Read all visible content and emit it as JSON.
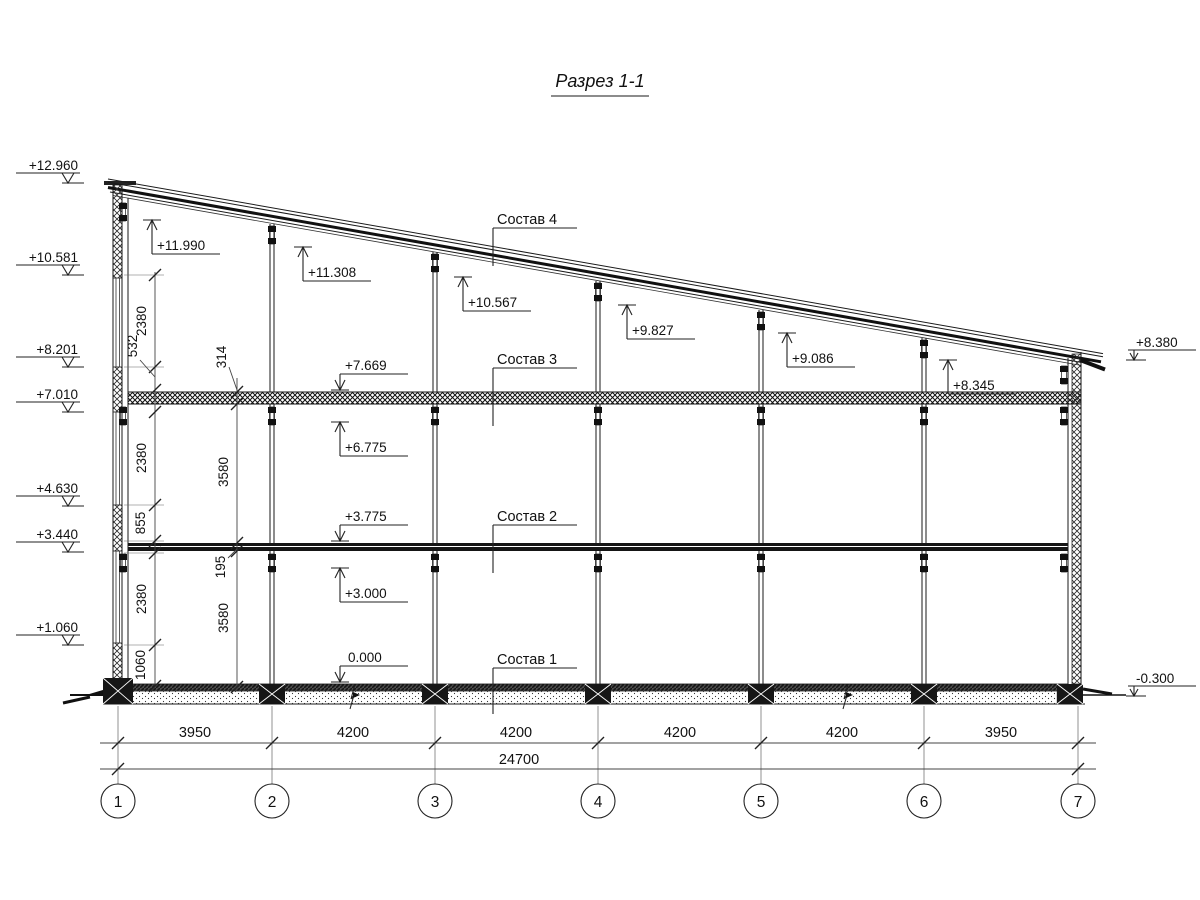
{
  "title": "Разрез 1-1",
  "layers": [
    "Состав 4",
    "Состав 3",
    "Состав 2",
    "Состав 1"
  ],
  "marks": {
    "left": [
      "+12.960",
      "+10.581",
      "+8.201",
      "+7.010",
      "+4.630",
      "+3.440",
      "+1.060"
    ],
    "right": [
      "+8.380",
      "-0.300"
    ],
    "roof": [
      "+11.990",
      "+11.308",
      "+10.567",
      "+9.827",
      "+9.086",
      "+8.345"
    ],
    "mid": [
      "+7.669",
      "+6.775",
      "+3.775",
      "+3.000",
      "0.000"
    ]
  },
  "vdims": {
    "inner": [
      "2380",
      "532",
      "2380",
      "855",
      "2380",
      "1060"
    ],
    "outer": [
      "314",
      "3580",
      "195",
      "3580"
    ]
  },
  "hdims": {
    "segments": [
      "3950",
      "4200",
      "4200",
      "4200",
      "4200",
      "3950"
    ],
    "total": "24700"
  },
  "axes": [
    "1",
    "2",
    "3",
    "4",
    "5",
    "6",
    "7"
  ]
}
